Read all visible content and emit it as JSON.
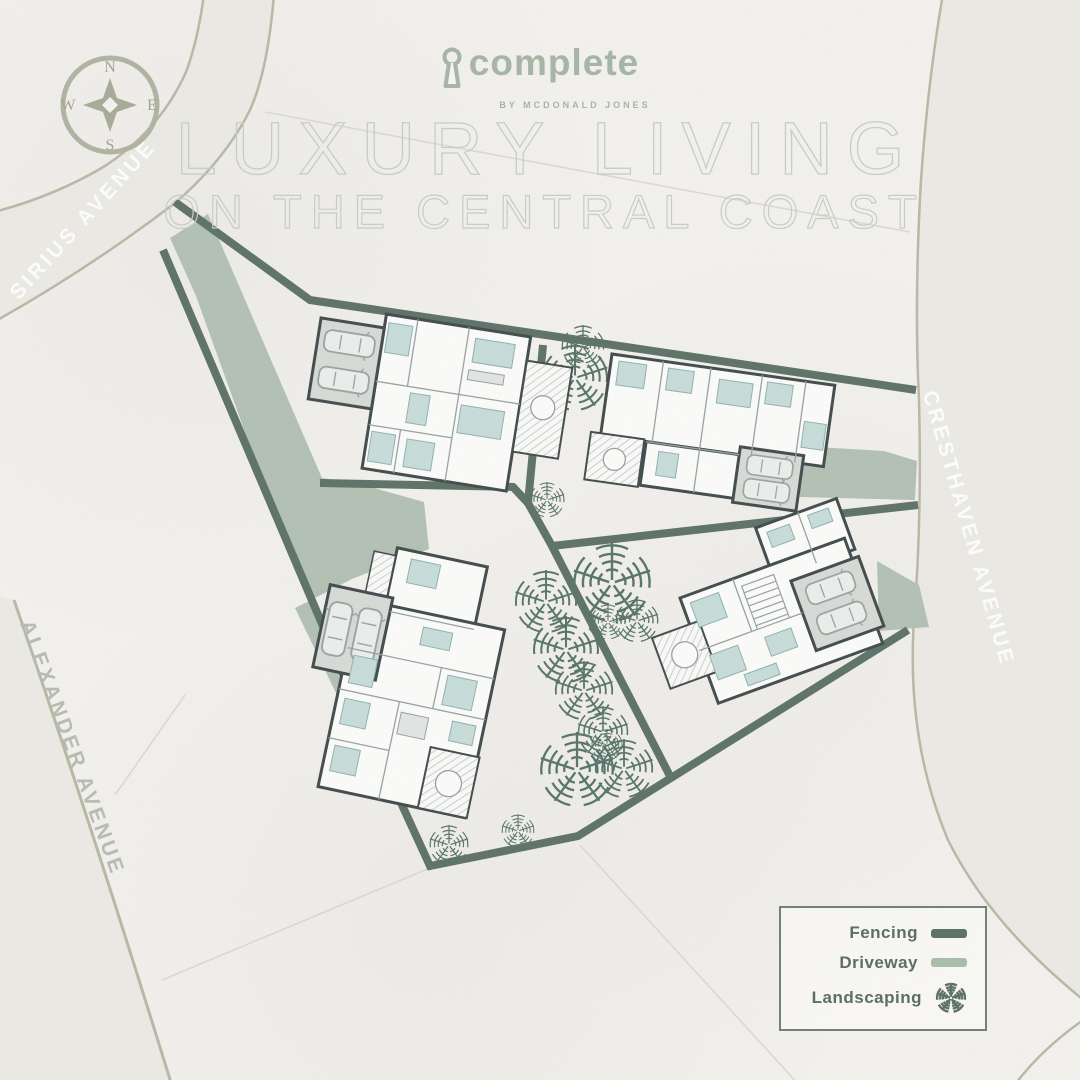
{
  "header": {
    "logo": {
      "brand": "complete",
      "byline": "BY MCDONALD JONES"
    },
    "title_line1": "LUXURY LIVING",
    "title_line2": "ON THE CENTRAL COAST"
  },
  "compass": {
    "north": "N",
    "east": "E",
    "south": "S",
    "west": "W"
  },
  "streets": [
    {
      "name": "SIRIUS AVENUE"
    },
    {
      "name": "ALEXANDER AVENUE"
    },
    {
      "name": "CRESTHAVEN AVENUE"
    }
  ],
  "legend": {
    "items": [
      {
        "label": "Fencing",
        "swatch": "fencing-line"
      },
      {
        "label": "Driveway",
        "swatch": "driveway-line"
      },
      {
        "label": "Landscaping",
        "swatch": "landscaping-tree-icon"
      }
    ]
  },
  "colors": {
    "fencing": "#5d7268",
    "driveway": "#b3c2b4",
    "landscaping": "#57746a",
    "brand_sage": "#a6b5a5",
    "road_edge": "#b9b9a5",
    "title_outline": "#c7cdc4"
  }
}
